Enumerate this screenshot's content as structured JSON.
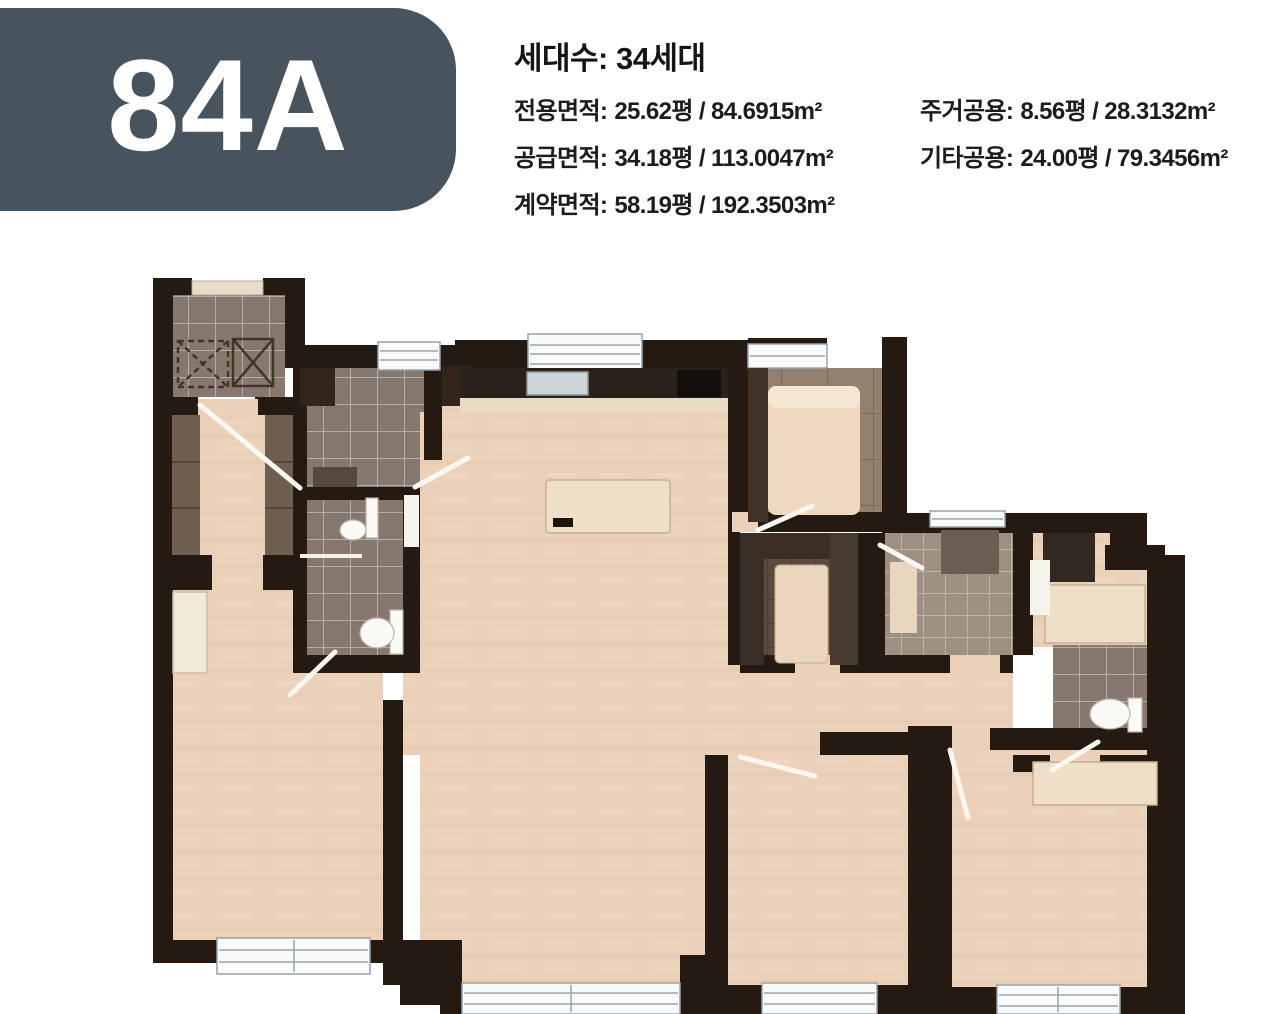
{
  "colors": {
    "badge": "#47545E",
    "wall": "#241a12",
    "floor": "#ecd1ba",
    "tile": "#87786d"
  },
  "header": {
    "unit_code": "84A",
    "households": "세대수: 34세대",
    "specs_left": [
      {
        "label": "전용면적:",
        "value": "25.62평 / 84.6915m²"
      },
      {
        "label": "공급면적:",
        "value": "34.18평 / 113.0047m²"
      },
      {
        "label": "계약면적:",
        "value": "58.19평 / 192.3503m²"
      }
    ],
    "specs_right": [
      {
        "label": "주거공용:",
        "value": "8.56평 / 28.3132m²"
      },
      {
        "label": "기타공용:",
        "value": "24.00평 / 79.3456m²"
      }
    ]
  }
}
